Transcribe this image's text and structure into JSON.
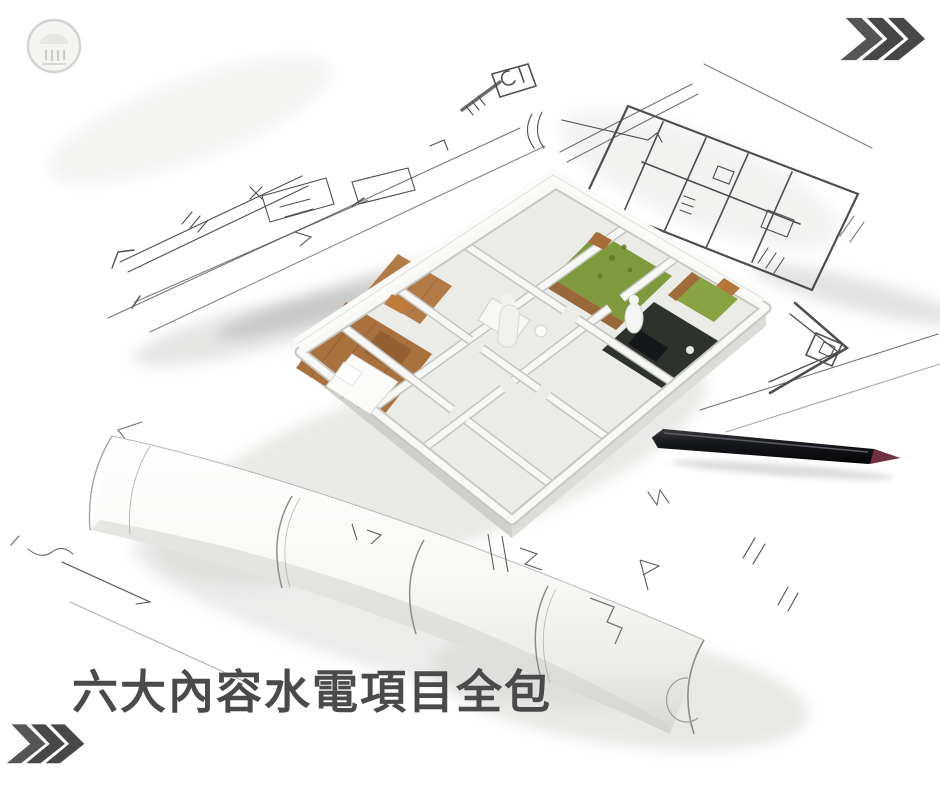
{
  "headline": {
    "text": "六大內容水電項目全包"
  },
  "logo": {
    "name": "circular-stamp-logo"
  },
  "decorations": {
    "top_right_chevrons": {
      "icon": "fast-forward-chevrons-icon",
      "count": 3,
      "direction": "right"
    },
    "bottom_left_chevrons": {
      "icon": "fast-forward-chevrons-icon",
      "count": 3,
      "direction": "right"
    }
  },
  "illustration": {
    "name": "house-model-on-blueprints",
    "elements": [
      "isometric-house-model",
      "hand-drawn-floor-plan-sketches",
      "rolled-blueprint",
      "black-pen"
    ]
  },
  "theme": {
    "background": "#ffffff",
    "headline_color": "#4a4a4a",
    "chevron_color": "#474747",
    "sketch_line": "#3c3c3c",
    "wall_white": "#f8f8f6",
    "wall_shadow": "#c7c7c4",
    "wood_floor": "#a9713e",
    "plant_green": "#7e9a3c",
    "dark_room": "#2e322d",
    "pen_black": "#17171a",
    "pen_tip_maroon": "#703041",
    "paper_shade": "#d9d9d6"
  }
}
